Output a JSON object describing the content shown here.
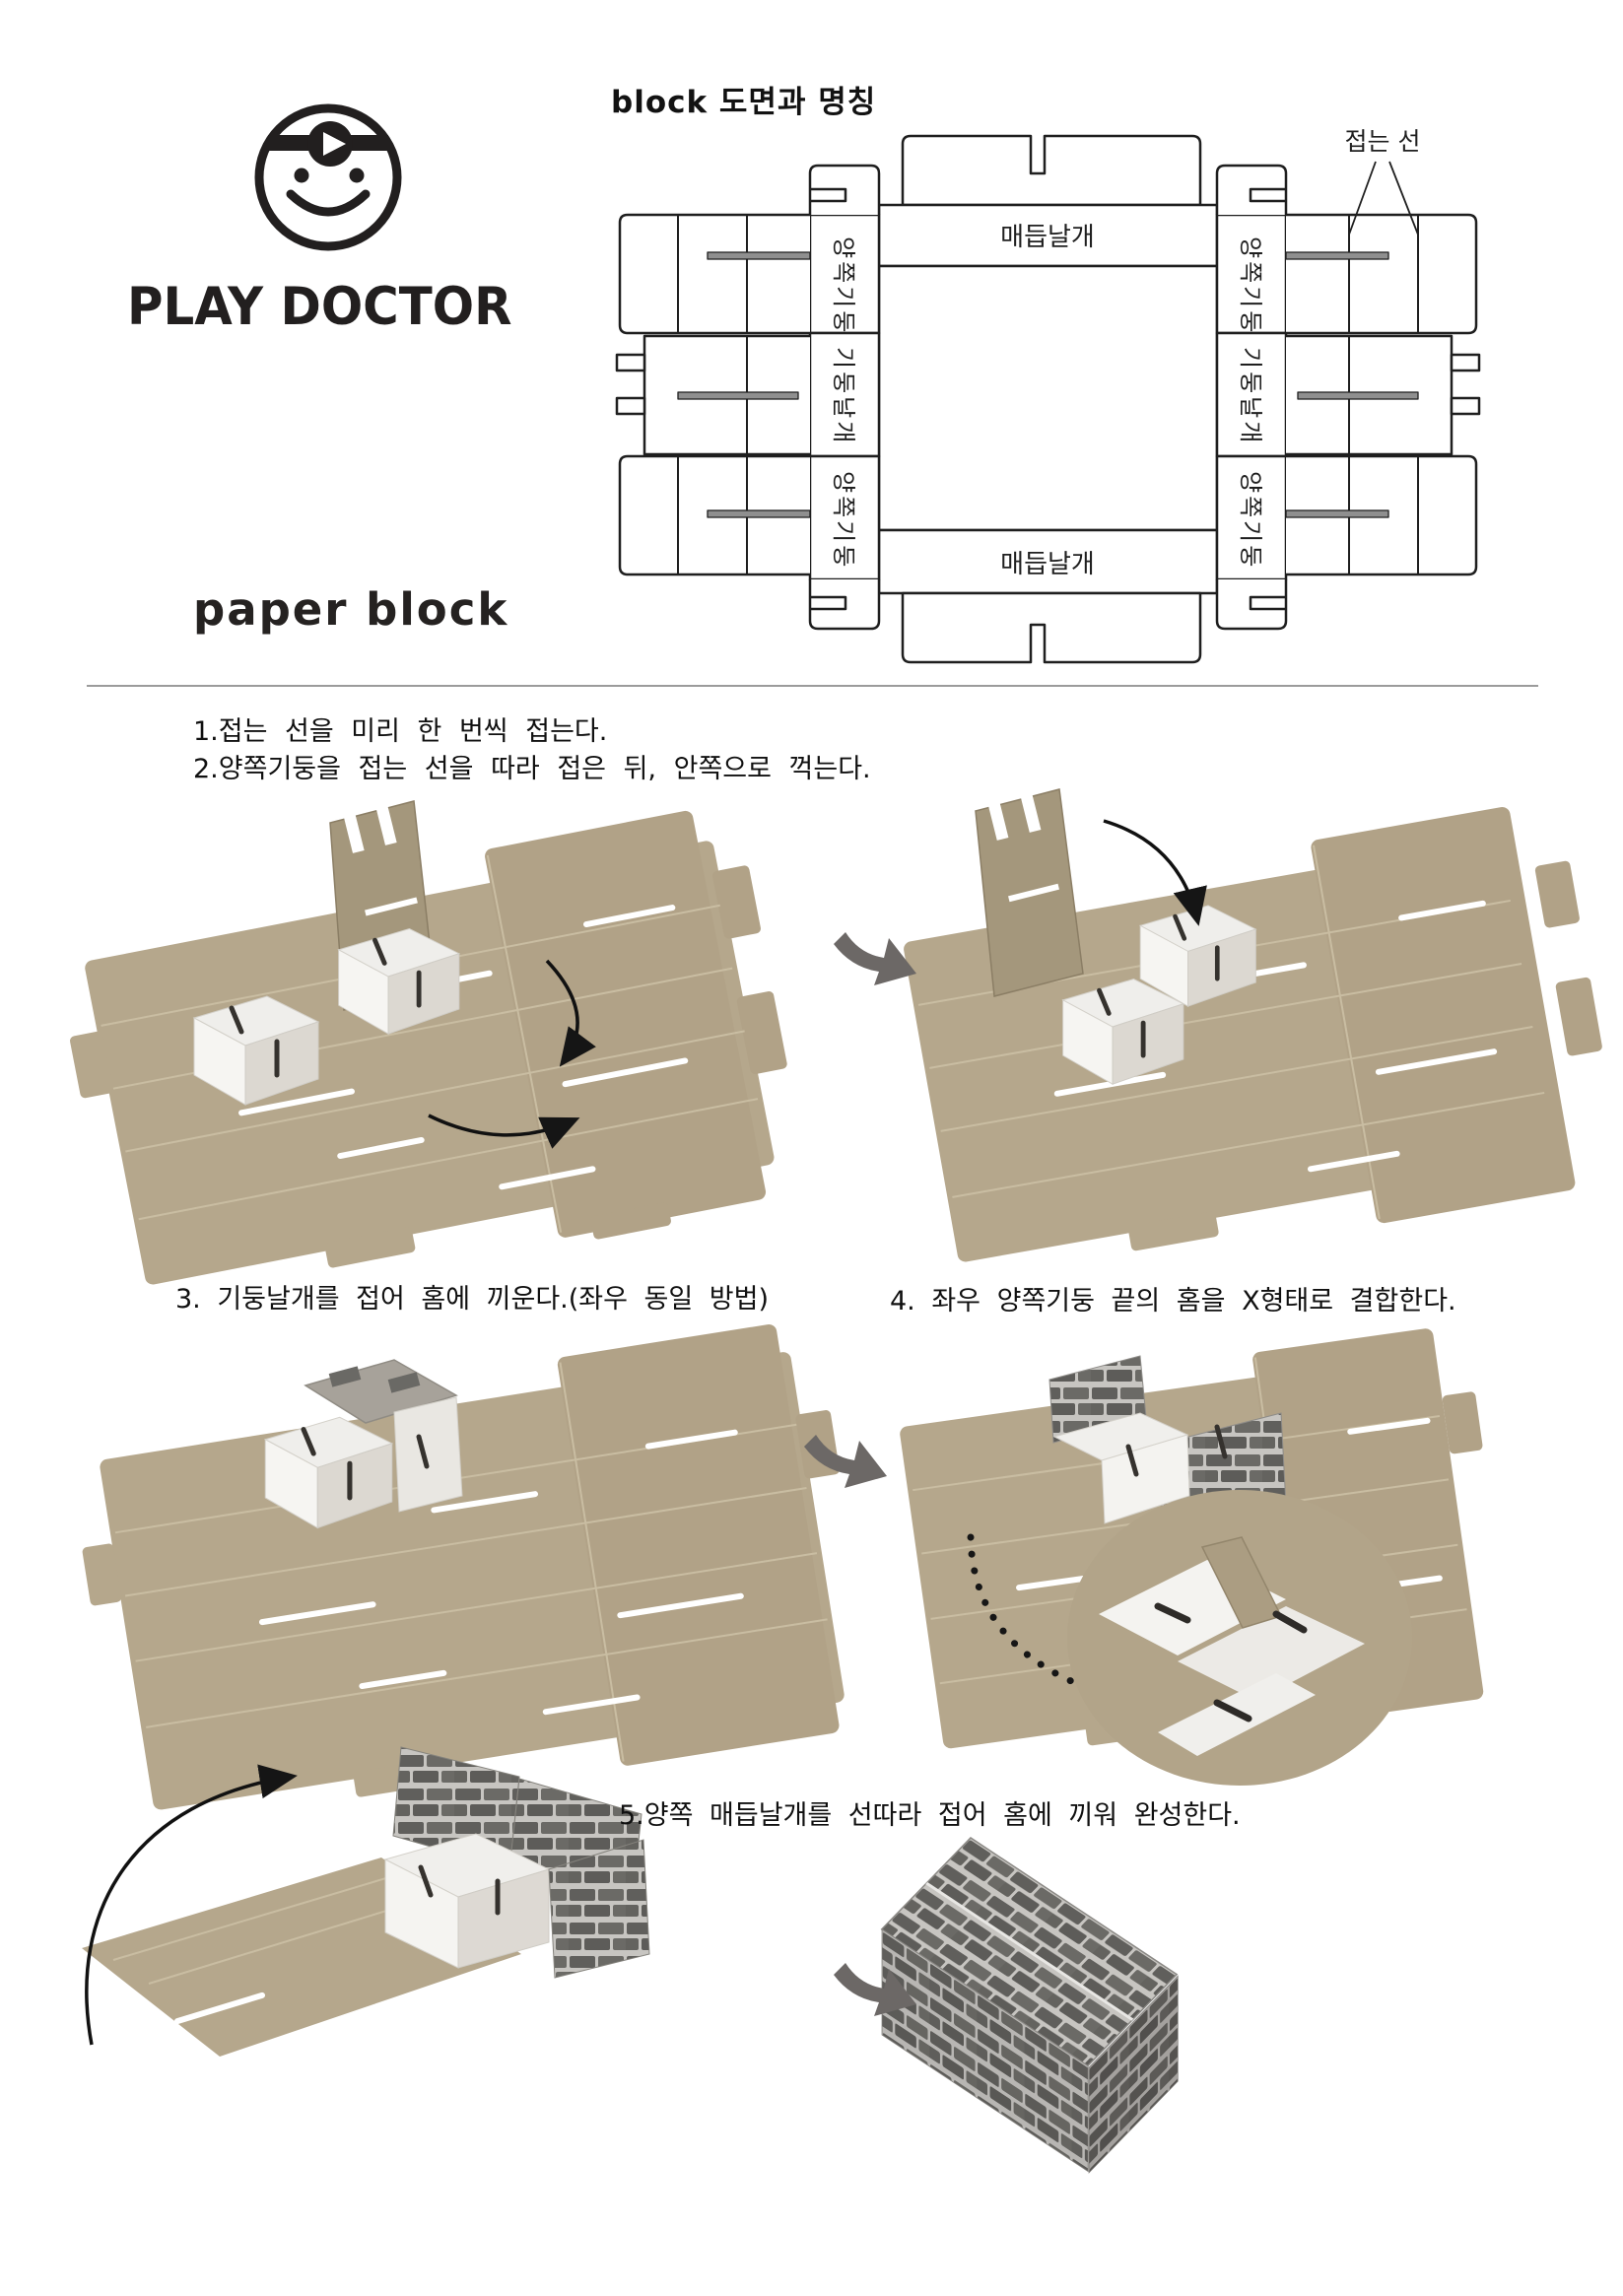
{
  "brand": {
    "logo_text": "PLAY DOCTOR",
    "product_text": "paper block"
  },
  "diagram": {
    "title": "block 도면과 명칭",
    "fold_line_label": "접는 선",
    "labels": {
      "knot_wing": "매듭날개",
      "side_pillar": "양쪽기둥",
      "pillar_wing": "기둥날개"
    }
  },
  "instructions": {
    "step1": "1.접는 선을 미리 한 번씩 접는다.",
    "step2": "2.양쪽기둥을 접는 선을 따라 접은 뒤, 안쪽으로 꺽는다.",
    "step3": "3. 기둥날개를 접어 홈에 끼운다.(좌우 동일 방법)",
    "step4": "4. 좌우 양쪽기둥 끝의 홈을 X형태로 결합한다.",
    "step5": "5.양쪽 매듭날개를 선따라 접어 홈에 끼워 완성한다."
  },
  "colors": {
    "ink": "#1f1f1f",
    "cardboard": "#b5a78c",
    "cardboard_dark": "#a4977c",
    "brick_dark": "#605f5c",
    "brick_mortar": "#c7c5c1",
    "arrow_gray": "#6c6866",
    "box_white": "#f3f2ef"
  }
}
